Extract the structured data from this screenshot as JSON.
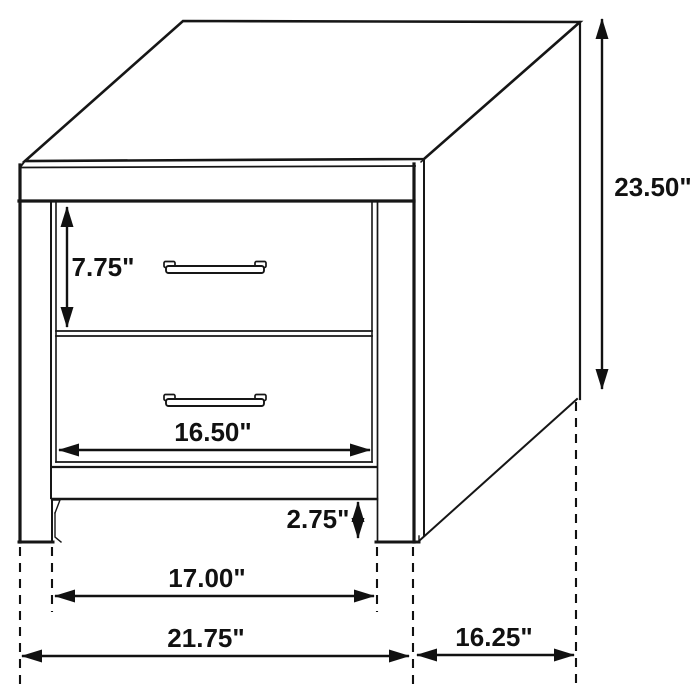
{
  "drawing": {
    "subject": "two-drawer-nightstand-dimension-diagram",
    "unit_symbol": "\""
  },
  "colors": {
    "background": "#ffffff",
    "line": "#161616",
    "shade_grey": "#9e9e9e"
  },
  "dimensions": {
    "overall_height": "23.50\"",
    "drawer_front_height": "7.75\"",
    "drawer_opening_width": "16.50\"",
    "base_clearance": "2.75\"",
    "inner_leg_span": "17.00\"",
    "overall_width": "21.75\"",
    "overall_depth": "16.25\""
  }
}
